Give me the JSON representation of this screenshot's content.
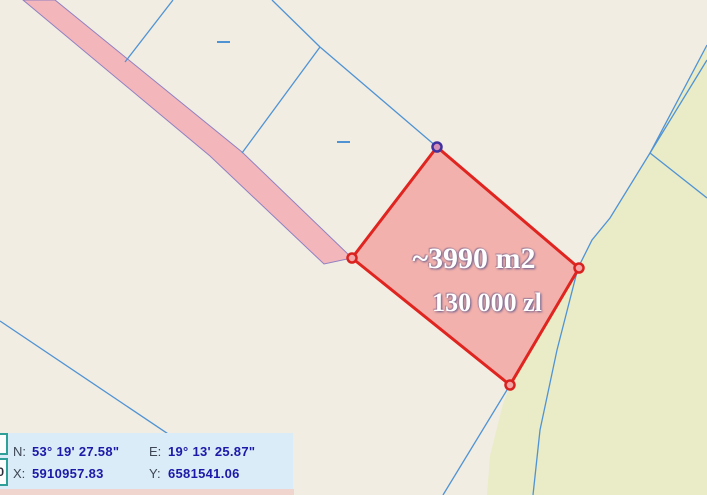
{
  "map": {
    "background_color": "#f1ede3",
    "line_color": "#5093d4",
    "green_area": {
      "fill": "#e9ecc7",
      "points": [
        [
          707,
          45
        ],
        [
          650,
          153
        ],
        [
          610,
          218
        ],
        [
          592,
          240
        ],
        [
          578,
          268
        ],
        [
          510,
          385
        ],
        [
          503,
          404
        ],
        [
          497,
          428
        ],
        [
          490,
          456
        ],
        [
          487,
          495
        ],
        [
          707,
          495
        ]
      ],
      "boundary_line": [
        [
          707,
          45
        ],
        [
          650,
          153
        ],
        [
          610,
          218
        ],
        [
          592,
          240
        ],
        [
          578,
          268
        ],
        [
          557,
          350
        ],
        [
          540,
          430
        ],
        [
          533,
          495
        ]
      ]
    },
    "road": {
      "fill": "#f3b6ba",
      "edge_color": "#9080c2",
      "points": [
        [
          55,
          0
        ],
        [
          242,
          152
        ],
        [
          352,
          258
        ],
        [
          324,
          264
        ],
        [
          210,
          156
        ],
        [
          23,
          0
        ]
      ]
    },
    "boundary_lines": [
      [
        [
          173,
          0
        ],
        [
          125,
          62
        ]
      ],
      [
        [
          272,
          0
        ],
        [
          320,
          47
        ]
      ],
      [
        [
          320,
          47
        ],
        [
          437,
          147
        ]
      ],
      [
        [
          320,
          47
        ],
        [
          242,
          153
        ]
      ],
      [
        [
          707,
          60
        ],
        [
          650,
          153
        ]
      ],
      [
        [
          650,
          153
        ],
        [
          707,
          198
        ]
      ],
      [
        [
          0,
          321
        ],
        [
          259,
          495
        ]
      ],
      [
        [
          510,
          385
        ],
        [
          443,
          495
        ]
      ]
    ],
    "tick_marks": [
      [
        [
          217,
          42
        ],
        [
          230,
          42
        ]
      ],
      [
        [
          337,
          142
        ],
        [
          350,
          142
        ]
      ]
    ],
    "parcel": {
      "points": [
        [
          437,
          147
        ],
        [
          579,
          268
        ],
        [
          510,
          385
        ],
        [
          352,
          258
        ]
      ],
      "fill": "rgba(242,128,128,0.55)",
      "stroke": "#e02420",
      "stroke_width": 3,
      "area_label": "~3990 m2",
      "price_label": "130 000 zl",
      "marker_red": {
        "stroke": "#d92220",
        "fill": "#f4a5a5"
      },
      "marker_selected": {
        "stroke": "#41319e",
        "fill": "#d590b8"
      },
      "vertices": [
        {
          "x": 352,
          "y": 258,
          "type": "red"
        },
        {
          "x": 579,
          "y": 268,
          "type": "red"
        },
        {
          "x": 510,
          "y": 385,
          "type": "red"
        },
        {
          "x": 437,
          "y": 147,
          "type": "selected"
        }
      ]
    }
  },
  "coordinate_panel": {
    "n_label": "N:",
    "n_value": "53° 19' 27.58\"",
    "e_label": "E:",
    "e_value": "19° 13' 25.87\"",
    "x_label": "X:",
    "x_value": "5910957.83",
    "y_label": "Y:",
    "y_value": "6581541.06"
  },
  "scale_box": {
    "value": "0"
  }
}
